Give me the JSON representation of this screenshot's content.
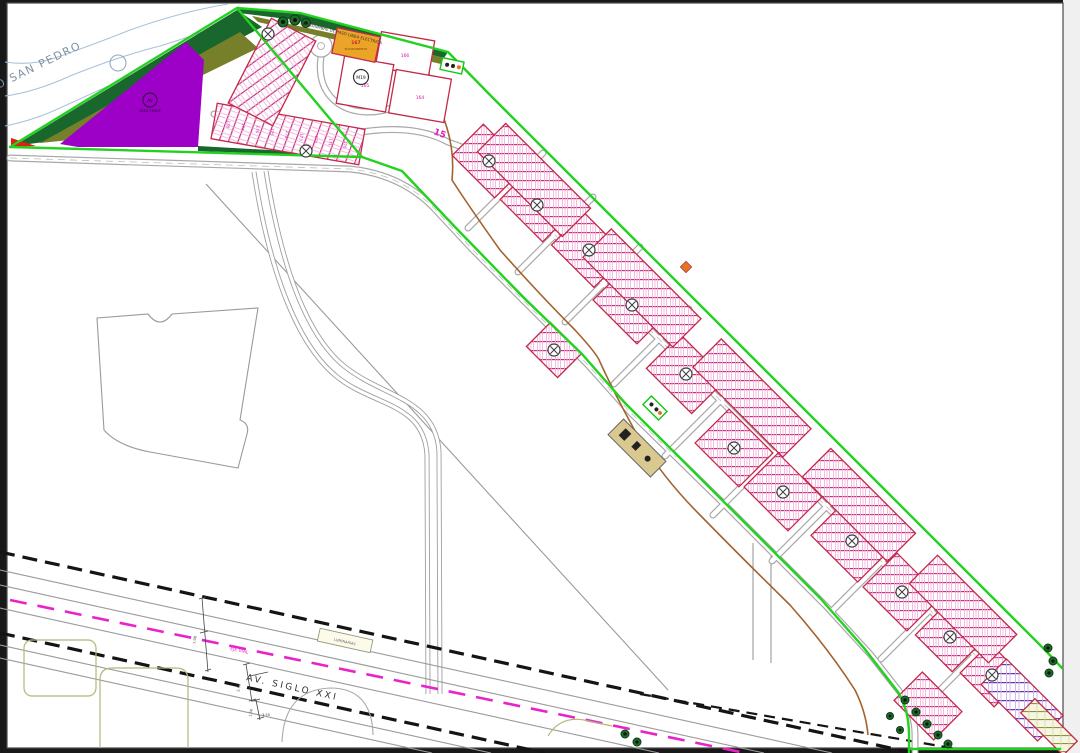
{
  "plan": {
    "river_label": "RIO SAN PEDRO",
    "avenue_label": "AV. SIGLO XXI",
    "centerline_label": "EJE VIAL",
    "easement_label": "SERVIDUMBRE DE PASO LINEA ELECTRICA",
    "sign_box_label": "LUMINARIAS",
    "green_area": {
      "circle_label": "AV",
      "caption": "AREA VERDE"
    },
    "equipment_lot": {
      "number": "167",
      "caption": "EQUIPAMIENTO"
    },
    "block_circle_label": "M19",
    "parcel_labels": [
      "166",
      "165",
      "164"
    ],
    "lot_row_numbers": [
      "178",
      "177",
      "176",
      "175",
      "174",
      "173",
      "172",
      "171",
      "170"
    ],
    "dimension_labels": [
      "7.00",
      "2.50",
      "1.50",
      "3.50"
    ],
    "colors": {
      "boundary_green": "#22d21f",
      "lot_line_magenta": "#c2307d",
      "area_purple": "#9d00c6",
      "area_olive": "#76802b",
      "area_darkgreen": "#19672c",
      "centerline_magenta": "#e923c9",
      "equipment_orange": "#eba428",
      "corridor_black": "#141414"
    }
  }
}
